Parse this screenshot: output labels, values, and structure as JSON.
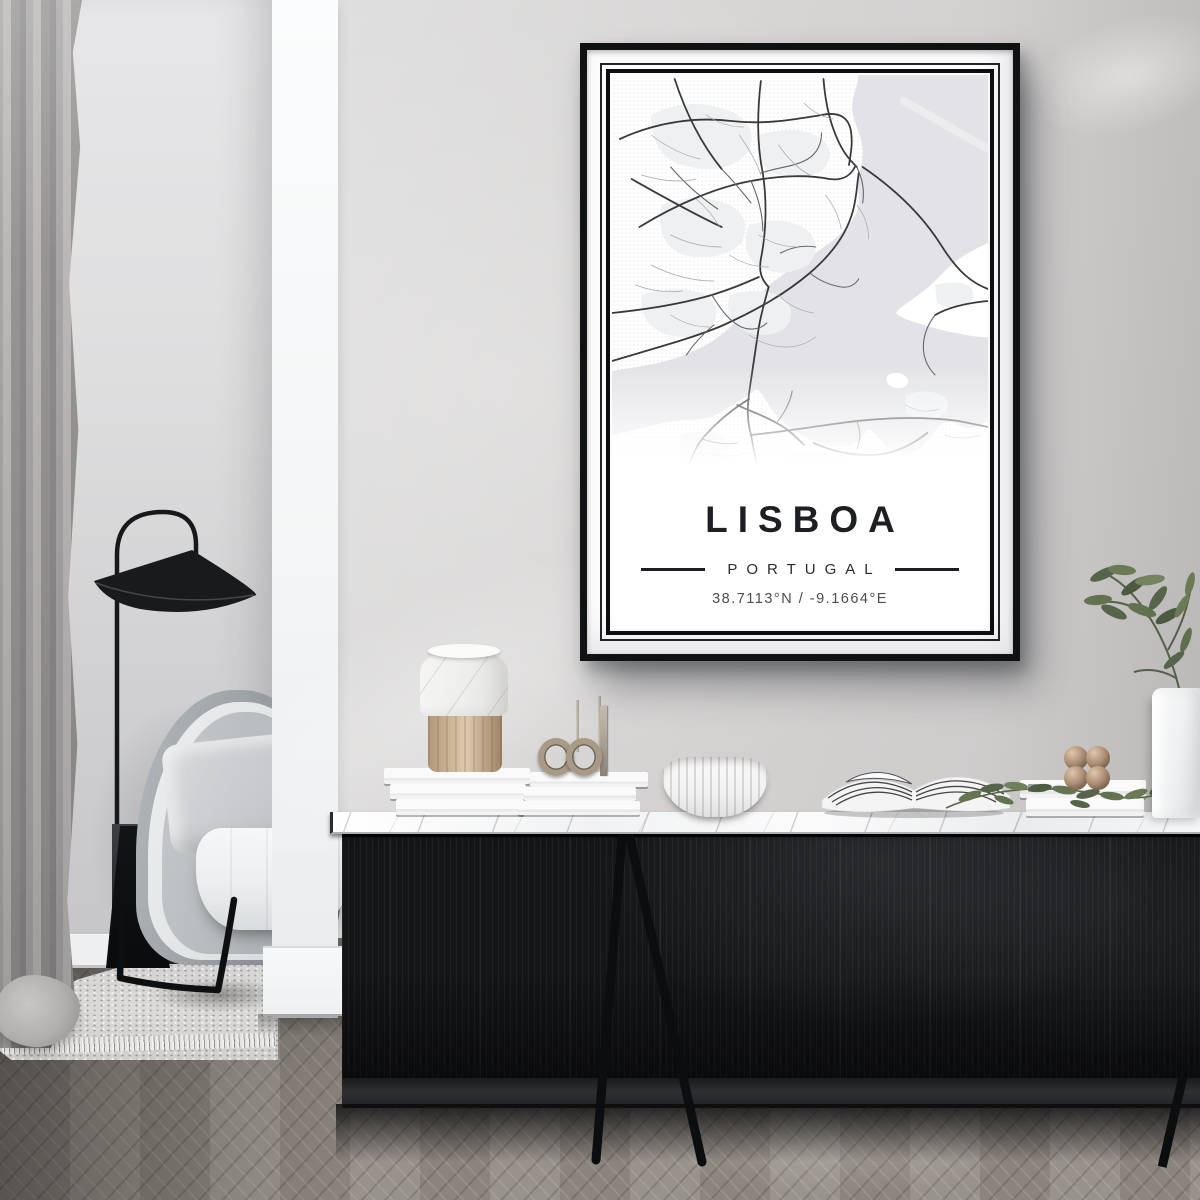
{
  "poster": {
    "title": "LISBOA",
    "subtitle": "PORTUGAL",
    "coordinates": "38.7113°N / -9.1664°E",
    "frame_color": "#101113",
    "mat_color": "#fcfcfd",
    "map": {
      "colors": {
        "land": "#ffffff",
        "water": "#e3e3e7",
        "district": "#eef0f1",
        "sandbar": "#ececef",
        "a": "#38383d",
        "b": "#64646a",
        "c": "#a8a8ae"
      },
      "water": [
        "M252,0 C250,14 243,26 246,40 C250,54 257,66 256,80 C255,96 249,104 252,118 C254,130 250,140 242,150 C226,168 204,180 186,192 C164,206 150,218 136,236 C120,256 100,270 74,280 C48,290 22,292 0,296 L0,360 C24,356 44,348 64,346 C84,344 96,346 110,338 C124,330 136,322 148,314 C154,318 158,328 166,338 C176,350 190,360 206,366 C222,372 240,374 252,366 C258,360 260,352 266,356 C274,364 282,376 296,378 C312,380 322,368 330,356 C336,346 344,344 354,350 C364,356 374,352 384,346 L384,0 Z"
      ],
      "land_overlays": [
        "M384,168 C366,176 352,184 340,196 C330,206 322,214 310,222 C302,228 294,232 290,238 C296,244 306,246 318,250 C332,254 348,258 362,260 C372,262 378,262 384,262 Z",
        "M282,300 C290,296 298,298 302,304 C304,310 298,314 290,313 C282,312 278,305 282,300 Z"
      ],
      "sandbars": [
        "M298,26 L384,74"
      ],
      "districts": [
        "M40,40 Q80,20 120,36 Q150,48 140,76 Q120,100 80,92 Q40,86 40,40 Z",
        "M150,60 Q190,48 215,64 Q230,80 214,96 Q190,108 164,98 Q144,86 150,60 Z",
        "M50,130 Q90,116 120,130 Q144,142 132,168 Q110,188 74,180 Q44,170 50,130 Z",
        "M140,150 Q180,140 200,156 Q216,172 200,190 Q176,204 150,192 Q130,178 140,150 Z",
        "M30,220 Q70,208 96,220 Q114,232 102,252 Q80,268 52,258 Q28,248 30,220 Z",
        "M120,220 Q156,210 176,224 Q190,238 176,254 Q154,266 132,254 Q114,242 120,220 Z",
        "M70,360 Q100,352 116,364 Q124,378 108,388 Q86,396 70,386 Z",
        "M180,380 Q210,372 228,382 Q236,392 222,398 Q200,402 184,394 Z",
        "M330,210 Q352,204 366,212 Q374,222 362,230 Q344,236 332,228 Z",
        "M300,320 Q324,312 340,322 Q348,334 334,342 Q314,348 300,338 Z"
      ],
      "roads": [
        {
          "t": "a",
          "d": "M160,212 C156,226 152,240 150,252 L140,318 C138,334 138,346 142,360 L150,402"
        },
        {
          "t": "a",
          "d": "M256,92 C292,116 318,142 336,170 C354,198 368,208 384,214"
        },
        {
          "t": "a",
          "d": "M0,286 C48,272 86,262 114,250 C150,234 178,218 202,198 C226,178 240,158 246,136 C250,122 250,110 252,98"
        },
        {
          "t": "a",
          "d": "M0,238 C40,234 74,228 102,220 C122,214 136,208 150,202"
        },
        {
          "t": "a",
          "d": "M8,64 C48,46 88,42 122,46 C158,50 188,44 214,40 C234,36 242,44 244,56 C246,68 244,78 242,90"
        },
        {
          "t": "a",
          "d": "M28,152 C68,128 108,112 142,106 C174,100 202,100 222,104 C236,106 244,100 248,92"
        },
        {
          "t": "a",
          "d": "M152,6 C148,40 148,70 154,98 C158,124 158,156 152,184 C150,196 152,204 160,212"
        },
        {
          "t": "a",
          "d": "M216,4 C218,30 224,52 232,68 C238,80 244,86 250,92"
        },
        {
          "t": "a",
          "d": "M64,4 C76,40 92,70 112,94"
        },
        {
          "t": "a",
          "d": "M20,104 C56,124 86,140 112,152"
        },
        {
          "t": "a",
          "d": "M142,360 C180,356 216,350 250,346 C288,342 322,342 354,346 C364,348 374,350 384,352"
        },
        {
          "t": "a",
          "d": "M140,324 C120,336 104,350 92,364 C84,374 80,386 76,400"
        },
        {
          "t": "a",
          "d": "M128,330 C140,336 154,340 168,348 C180,354 188,362 196,370"
        },
        {
          "t": "a",
          "d": "M206,368 C224,376 242,380 262,380 C288,380 306,370 322,358"
        },
        {
          "t": "a",
          "d": "M384,226 C362,228 344,232 330,240"
        },
        {
          "t": "b",
          "d": "M152,98 C170,92 186,92 200,84 C210,78 214,68 214,58"
        },
        {
          "t": "b",
          "d": "M102,220 C112,236 120,246 132,252 C142,256 152,254 158,248"
        },
        {
          "t": "b",
          "d": "M250,92 C256,104 258,116 256,128"
        },
        {
          "t": "b",
          "d": "M60,92 C74,108 90,122 108,134"
        },
        {
          "t": "b",
          "d": "M142,106 C150,124 154,140 154,156"
        },
        {
          "t": "b",
          "d": "M202,198 C212,206 222,210 234,212 C242,213 248,210 252,204"
        },
        {
          "t": "b",
          "d": "M112,94 C124,106 134,118 142,128"
        },
        {
          "t": "b",
          "d": "M76,280 C84,268 94,258 104,250"
        },
        {
          "t": "b",
          "d": "M168,348 C176,338 182,328 184,316"
        },
        {
          "t": "b",
          "d": "M250,346 C254,356 254,366 250,374"
        },
        {
          "t": "b",
          "d": "M330,240 C322,250 318,260 318,272 C318,282 322,292 330,300"
        },
        {
          "t": "b",
          "d": "M92,364 C104,368 116,370 128,368"
        },
        {
          "t": "b",
          "d": "M172,178 C184,172 196,170 208,172"
        },
        {
          "t": "c",
          "d": "M40,60 C56,72 72,80 90,84"
        },
        {
          "t": "c",
          "d": "M30,100 C50,106 68,108 86,104"
        },
        {
          "t": "c",
          "d": "M130,60 C140,74 148,88 152,100"
        },
        {
          "t": "c",
          "d": "M170,70 C180,84 190,94 202,100"
        },
        {
          "t": "c",
          "d": "M60,160 C76,168 94,172 112,172"
        },
        {
          "t": "c",
          "d": "M40,190 C60,200 82,206 104,206"
        },
        {
          "t": "c",
          "d": "M150,160 C162,168 176,172 190,172"
        },
        {
          "t": "c",
          "d": "M170,220 C180,230 192,236 206,238"
        },
        {
          "t": "c",
          "d": "M60,240 C72,248 86,252 100,252"
        },
        {
          "t": "c",
          "d": "M140,260 C152,268 164,272 178,272 C190,272 200,268 208,262"
        },
        {
          "t": "c",
          "d": "M100,378 C112,382 124,382 136,378"
        },
        {
          "t": "c",
          "d": "M200,388 C212,392 226,392 238,388"
        },
        {
          "t": "c",
          "d": "M300,330 C310,336 322,338 334,334"
        },
        {
          "t": "c",
          "d": "M340,360 C352,364 364,364 376,360"
        },
        {
          "t": "c",
          "d": "M250,130 C258,140 262,152 262,164"
        },
        {
          "t": "c",
          "d": "M218,120 C226,130 232,142 234,154"
        },
        {
          "t": "c",
          "d": "M96,40 C108,48 120,52 134,52"
        },
        {
          "t": "c",
          "d": "M196,28 C204,36 214,42 226,44"
        },
        {
          "t": "c",
          "d": "M120,180 C132,188 146,192 160,192"
        },
        {
          "t": "c",
          "d": "M86,124 C96,132 104,142 110,152"
        },
        {
          "t": "c",
          "d": "M24,210 C40,216 56,218 72,216"
        }
      ]
    }
  },
  "scene": {
    "palette": {
      "wall": "#d6d4d3",
      "alcove_wall": "#dededf",
      "column": "#f3f5f6",
      "curtain": "#a7a5a5",
      "floor": "#8f8982",
      "rug": "#d8d7d5",
      "sideboard_body": "#141517",
      "marble_top": "#f6f7f8",
      "chair_shell": "#9fa4a9",
      "chair_seat": "#f3f4f5",
      "lamp": "#17181a",
      "plant_green": "#5c6a4c",
      "bronze": "#aa8d72"
    }
  }
}
